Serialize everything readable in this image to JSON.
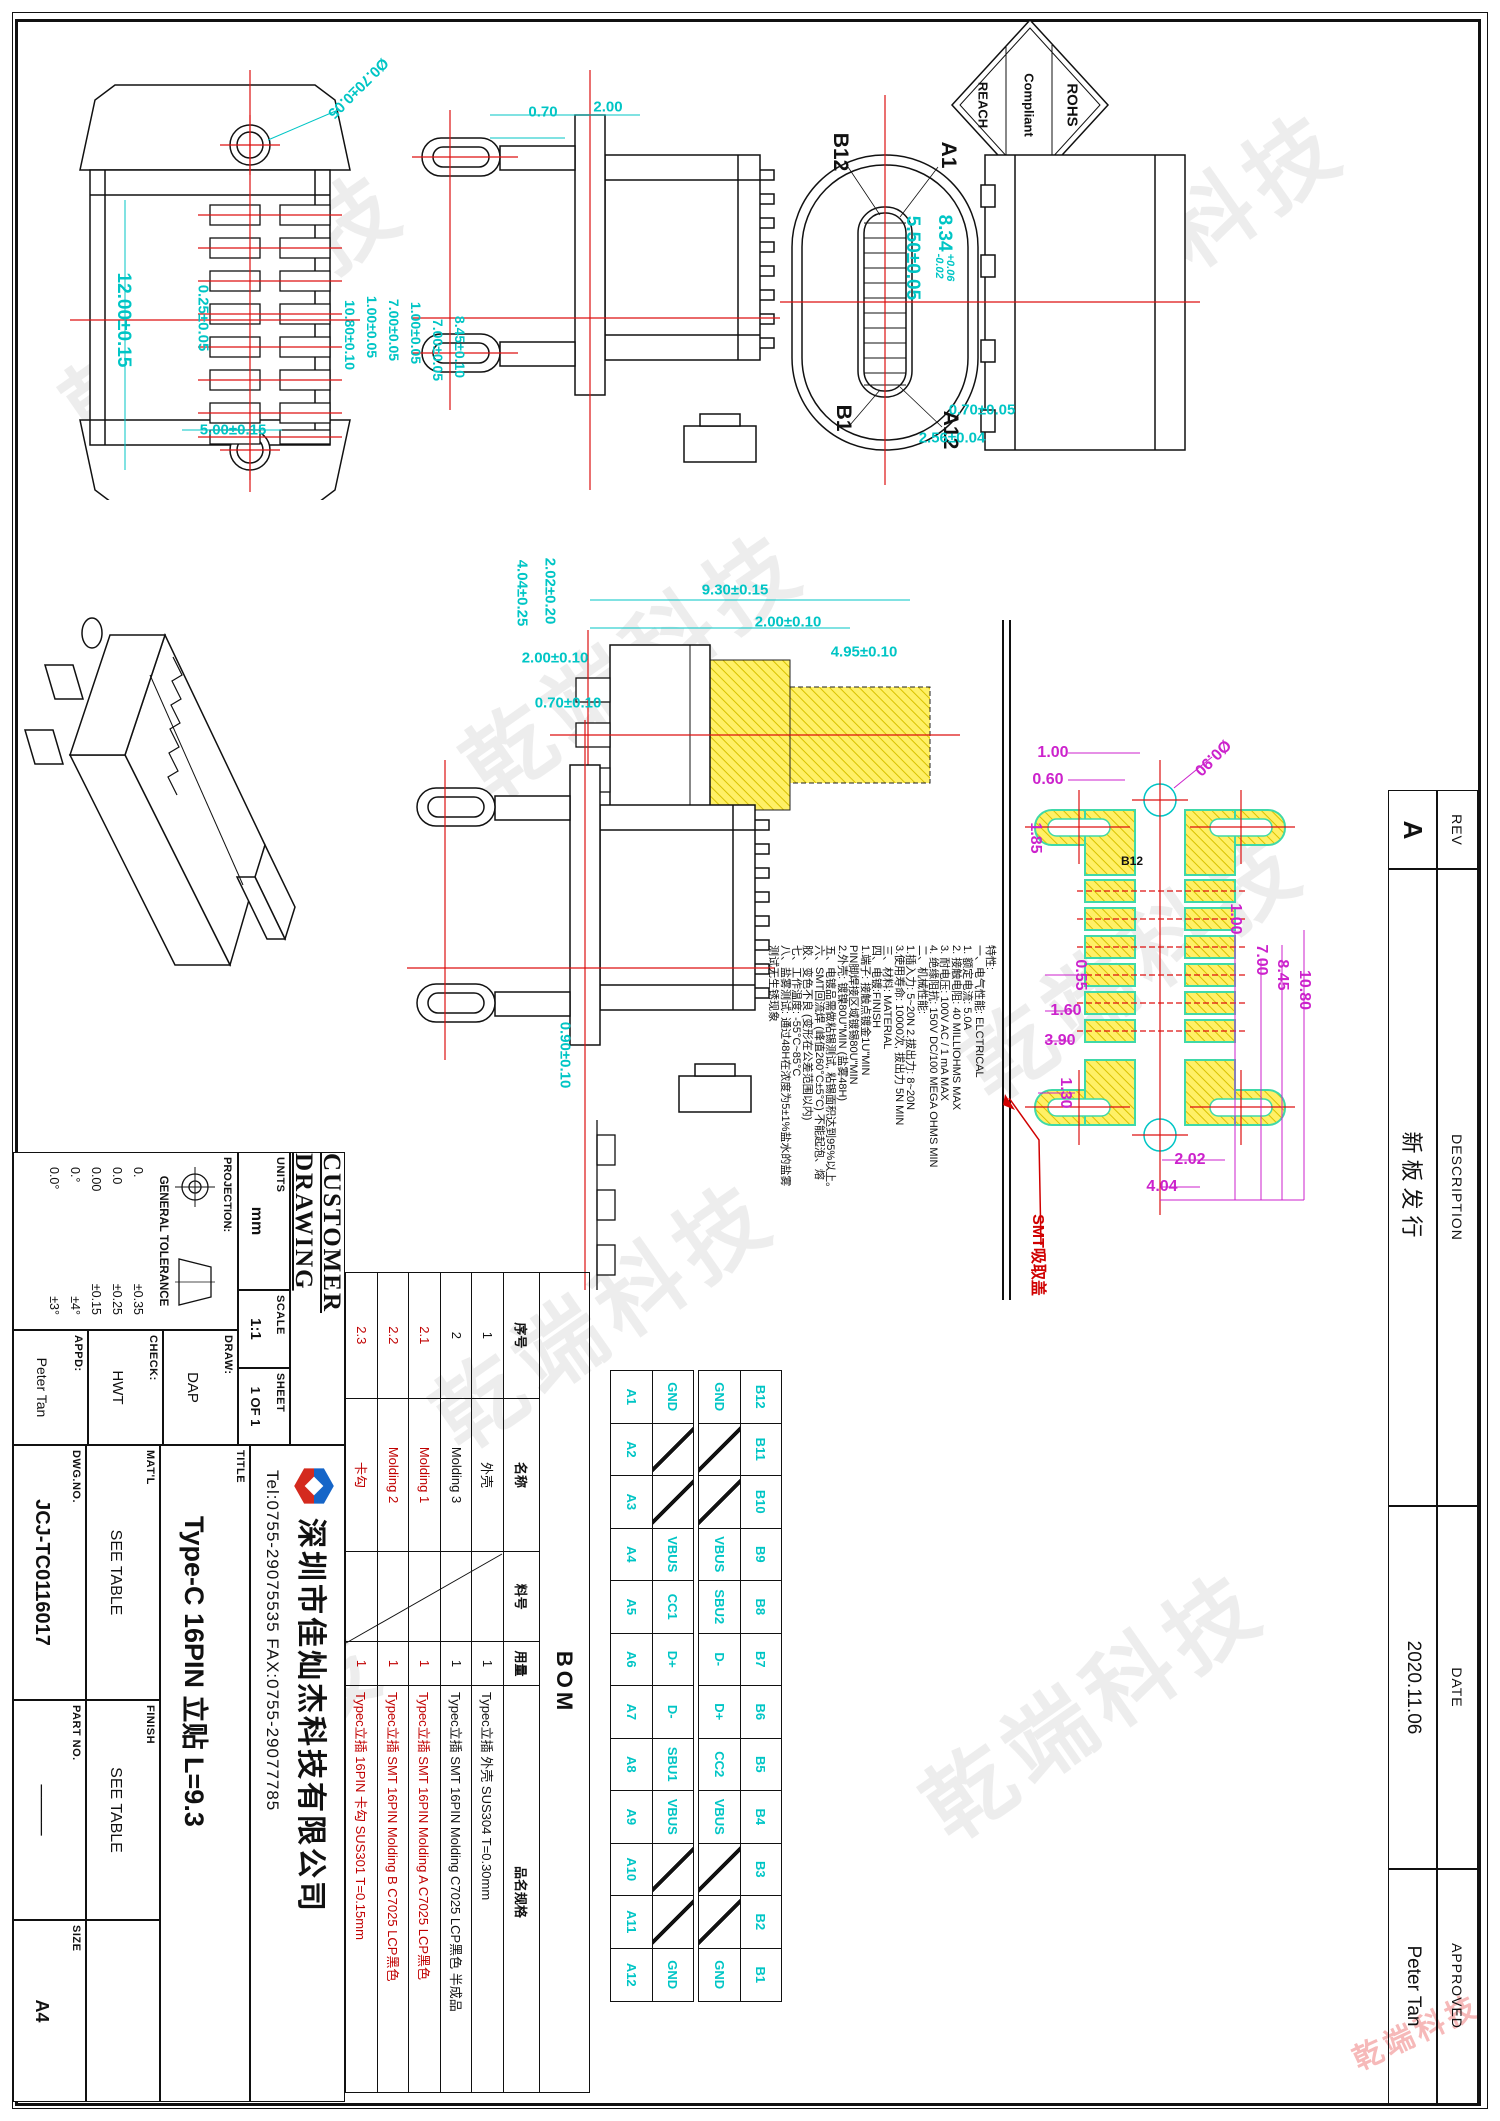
{
  "watermark": {
    "text": "乾端科技"
  },
  "colors": {
    "dim_cyan": "#00C5C5",
    "dim_magenta": "#CC22CC",
    "centerline_red": "#DD1111",
    "pad_yellow": "#FFF066",
    "pad_green": "#3FD9A8",
    "note_red": "#D00000"
  },
  "rohs": {
    "line1": "ROHS",
    "line2": "Compliant",
    "line3": "REACH"
  },
  "revision": {
    "headers": [
      "REV",
      "DESCRIPTION",
      "DATE",
      "APPROVED"
    ],
    "values": {
      "rev": "A",
      "description": "新板发行",
      "date": "2020.11.06",
      "approved": "Peter Tan"
    }
  },
  "views": {
    "front": {
      "dims": {
        "hole": "Ø0.70±0.05",
        "pin_offset": "0.25±0.05",
        "length": "12.00±0.15",
        "pitch": "1.00±0.05",
        "span": "7.00±0.05",
        "width": "5.00±0.15"
      }
    },
    "side_top": {
      "dims": {
        "d1": "2.00",
        "d2": "0.70",
        "pitch": "1.00±0.05",
        "span": "7.00±0.05",
        "height": "10.80±0.10",
        "body": "8.45±0.10"
      }
    },
    "mating": {
      "pins": {
        "b12": "B12",
        "a1": "A1",
        "b1": "B1",
        "a12": "A12"
      },
      "dims": {
        "slot": "5.50±0.05",
        "width": "8.34",
        "width_tol_up": "+0.06",
        "width_tol_dn": "-0.02",
        "tab": "0.70±0.05",
        "edge": "2.56±0.04"
      }
    },
    "section": {
      "dims": {
        "d1": "9.30±0.15",
        "d2": "2.00±0.10",
        "d3": "4.95±0.10",
        "d4": "2.02±0.20",
        "d5": "4.04±0.25"
      }
    },
    "side_bottom": {
      "dims": {
        "d1": "2.00±0.10",
        "d2": "0.70±0.10",
        "d3": "0.90±0.10"
      }
    },
    "land": {
      "pad_label": "B12",
      "smt_label": "SMT吸取盖",
      "dims": {
        "p1": "1.00",
        "p2": "0.60",
        "p3": "1.85",
        "hole": "Ø0.90",
        "r1": "1.00",
        "r2": "7.00",
        "r3": "8.45",
        "r4": "10.80",
        "b1": "0.55",
        "b2": "1.60",
        "b3": "3.90",
        "b4": "1.30",
        "c1": "2.02",
        "c2": "4.04"
      }
    }
  },
  "notes": {
    "lines": [
      "特性:",
      "一、电气性能: ELCTRICAL",
      "1. 额定电流: 5.0A",
      "2. 接触电阻: 40 MILLIOHMS MAX",
      "3. 耐电压: 100V AC / 1 mA MAX",
      "4. 绝缘阻抗: 150V DC/100 MEGA OHMS MIN",
      "二、机械性能:",
      "1.插入力: 5~20N  2.拔出力: 8~20N",
      "3.使用寿命: 10000次, 拔出力 5N MIN",
      "三、材料: MATERIAL",
      "四、电镀:FINISH",
      "1.端子: 接触点镀金1U\"MIN",
      "        PIN脚焊接区域镀锡80U\"MIN",
      "2.外壳: 镀镍80U\"MIN (盐雾48H)",
      "五、电镀品需做粘锡测试, 粘锡面积达到95%以上。",
      "六、SMT回流焊 (峰值260°C±5°C) 不能起泡、熔",
      "胶、变色不良 (变形在公差范围以内)",
      "七、工作温度: -55°C~85°C",
      "八、盐雾测试: 通过48H在浓度为5±1%盐水的盐雾",
      "测试无生锈现象"
    ]
  },
  "pin_table": {
    "b_pins": [
      "B12",
      "B11",
      "B10",
      "B9",
      "B8",
      "B7",
      "B6",
      "B5",
      "B4",
      "B3",
      "B2",
      "B1"
    ],
    "b_signals": [
      "GND",
      "",
      "",
      "VBUS",
      "SBU2",
      "D-",
      "D+",
      "CC2",
      "VBUS",
      "",
      "",
      "GND"
    ],
    "a_signals": [
      "GND",
      "",
      "",
      "VBUS",
      "CC1",
      "D+",
      "D-",
      "SBU1",
      "VBUS",
      "",
      "",
      "GND"
    ],
    "a_pins": [
      "A1",
      "A2",
      "A3",
      "A4",
      "A5",
      "A6",
      "A7",
      "A8",
      "A9",
      "A10",
      "A11",
      "A12"
    ]
  },
  "bom": {
    "title": "BOM",
    "headers": [
      "序号",
      "名称",
      "料号",
      "用量",
      "品名规格"
    ],
    "rows": [
      {
        "no": "1",
        "name": "外壳",
        "qty": "1",
        "spec": "Typec立插 外壳 SUS304 T=0.30mm",
        "red": false
      },
      {
        "no": "2",
        "name": "Molding 3",
        "qty": "1",
        "spec": "Typec立插 SMT 16PIN Molding C7025 LCP黑色 半成品",
        "red": false
      },
      {
        "no": "2.1",
        "name": "Molding 1",
        "qty": "1",
        "spec": "Typec立插 SMT 16PIN Molding A C7025 LCP黑色",
        "red": true
      },
      {
        "no": "2.2",
        "name": "Molding 2",
        "qty": "1",
        "spec": "Typec立插 SMT 16PIN Molding B C7025 LCP黑色",
        "red": true
      },
      {
        "no": "2.3",
        "name": "卡勾",
        "qty": "1",
        "spec": "Typec立插 16PIN 卡勾 SUS301 T=0.15mm",
        "red": true
      }
    ]
  },
  "title_block": {
    "customer_drawing": "CUSTOMER DRAWING",
    "units_label": "UNITS",
    "units_value": "mm",
    "scale_label": "SCALE",
    "scale_value": "1:1",
    "sheet_label": "SHEET",
    "sheet_value": "1 OF 1",
    "projection_label": "PROJECTION:",
    "tolerance_label": "GENERAL TOLERANCE",
    "tolerances": [
      [
        "0.",
        "±0.35"
      ],
      [
        "0.0",
        "±0.25"
      ],
      [
        "0.00",
        "±0.15"
      ],
      [
        "0.°",
        "±4°"
      ],
      [
        "0.0°",
        "±3°"
      ]
    ],
    "draw_label": "DRAW:",
    "draw_value": "DAP",
    "check_label": "CHECK:",
    "check_value": "HWT",
    "appd_label": "APPD:",
    "appd_value": "Peter Tan",
    "company": "深圳市佳灿杰科技有限公司",
    "tel": "Tel:0755-29075535 FAX:0755-29077785",
    "title_label": "TITLE",
    "title_value": "Type-C 16PIN 立贴 L=9.3",
    "matl_label": "MAT'L",
    "matl_value": "SEE TABLE",
    "finish_label": "FINISH",
    "finish_value": "SEE TABLE",
    "dwg_label": "DWG.NO.",
    "dwg_value": "JCJ-TC0116017",
    "part_label": "PART NO.",
    "part_value": "────",
    "size_label": "SIZE",
    "size_value": "A4"
  }
}
